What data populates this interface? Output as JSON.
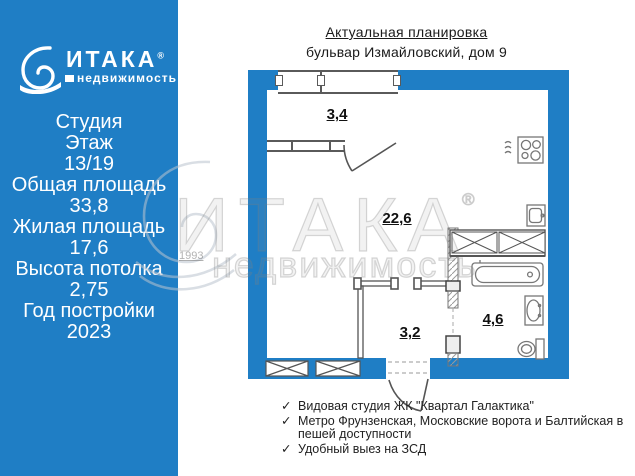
{
  "colors": {
    "brand_blue": "#1f7ec5",
    "plan_line_gray": "#5a5a5a",
    "watermark_gray": "#9a9a9a",
    "text_white": "#ffffff",
    "text_black": "#1a1a1a"
  },
  "brand": {
    "name": "ИТАКА",
    "registered": "®",
    "tagline": "недвижимость"
  },
  "left_panel": {
    "lines": [
      "Студия",
      "Этаж",
      "13/19",
      "Общая площадь",
      "33,8",
      "Жилая площадь",
      "17,6",
      "Высота потолка",
      "2,75",
      "Год постройки",
      "2023"
    ]
  },
  "plan": {
    "title": "Актуальная планировка",
    "subtitle": "бульвар Измайловский, дом 9",
    "rooms": [
      {
        "name": "балкон",
        "area": "3,4"
      },
      {
        "name": "комната-студия",
        "area": "22,6"
      },
      {
        "name": "прихожая",
        "area": "3,2"
      },
      {
        "name": "санузел",
        "area": "4,6"
      }
    ]
  },
  "watermark": {
    "brand": "ИТАКА",
    "registered": "®",
    "tagline": "недвижимость",
    "year": "1993"
  },
  "features": {
    "check": "✓",
    "items": [
      "Видовая студия ЖК \"Квартал Галактика\"",
      "Метро Фрунзенская, Московские ворота и Балтийская в пешей доступности",
      "Удобный выез на ЗСД"
    ]
  }
}
